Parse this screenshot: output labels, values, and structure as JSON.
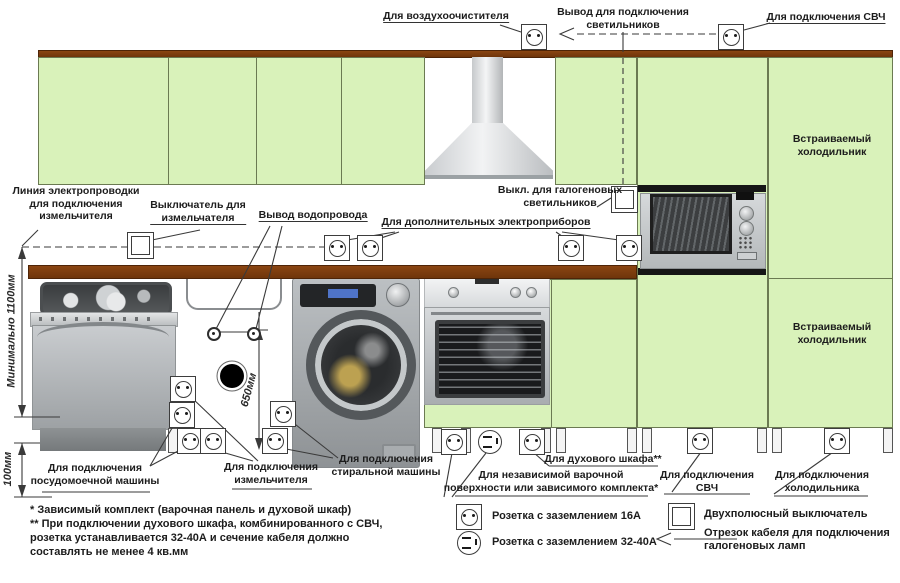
{
  "colors": {
    "cabinet_green": "#d9f2ba",
    "counter_brown": "#7a3c0e",
    "line": "#333333"
  },
  "top": {
    "air": "Для воздухоочистителя",
    "lights1": "Вывод для подключения",
    "lights2": "светильников",
    "microwave": "Для подключения СВЧ"
  },
  "mid": {
    "wiring1": "Линия электропроводки",
    "wiring2": "для подключения",
    "wiring3": "измельчителя",
    "gr_switch1": "Выключатель для",
    "gr_switch2": "измельчателя",
    "water": "Вывод водопровода",
    "extra": "Для дополнительных электроприборов",
    "halogen1": "Выкл. для галогеновых",
    "halogen2": "светильников",
    "fridge1": "Встраиваемый",
    "fridge2": "холодильник"
  },
  "bottom": {
    "dw1": "Для подключения",
    "dw2": "посудомоечной машины",
    "gr1": "Для подключения",
    "gr2": "измельчителя",
    "wm1": "Для подключения",
    "wm2": "стиральной машины",
    "hob1": "Для независимой варочной",
    "hob2": "поверхности или зависимого комплекта*",
    "oven": "Для духового шкафа**",
    "mw1": "Для подключения",
    "mw2": "СВЧ",
    "fr1": "Для подключения",
    "fr2": "холодильника"
  },
  "dims": {
    "h1100": "Минимально 1100мм",
    "h650": "650мм",
    "h100": "100мм"
  },
  "notes": [
    "* Зависимый комплект (варочная панель и духовой шкаф)",
    "** При подключении духового шкафа, комбинированного с СВЧ,",
    "розетка устанавливается 32-40А и сечение кабеля должно",
    "составлять не менее 4 кв.мм"
  ],
  "legend": {
    "socket16_icon": "socket-16a-icon",
    "socket16": "Розетка с заземлением 16А",
    "socket3240_icon": "socket-32-40a-icon",
    "socket3240": "Розетка с заземлением 32-40А",
    "switch_icon": "two-pole-switch-icon",
    "switch": "Двухполюсный выключатель",
    "cable_icon": "halogen-cable-icon",
    "cable1": "Отрезок кабеля для подключения",
    "cable2": "галогеновых ламп"
  }
}
